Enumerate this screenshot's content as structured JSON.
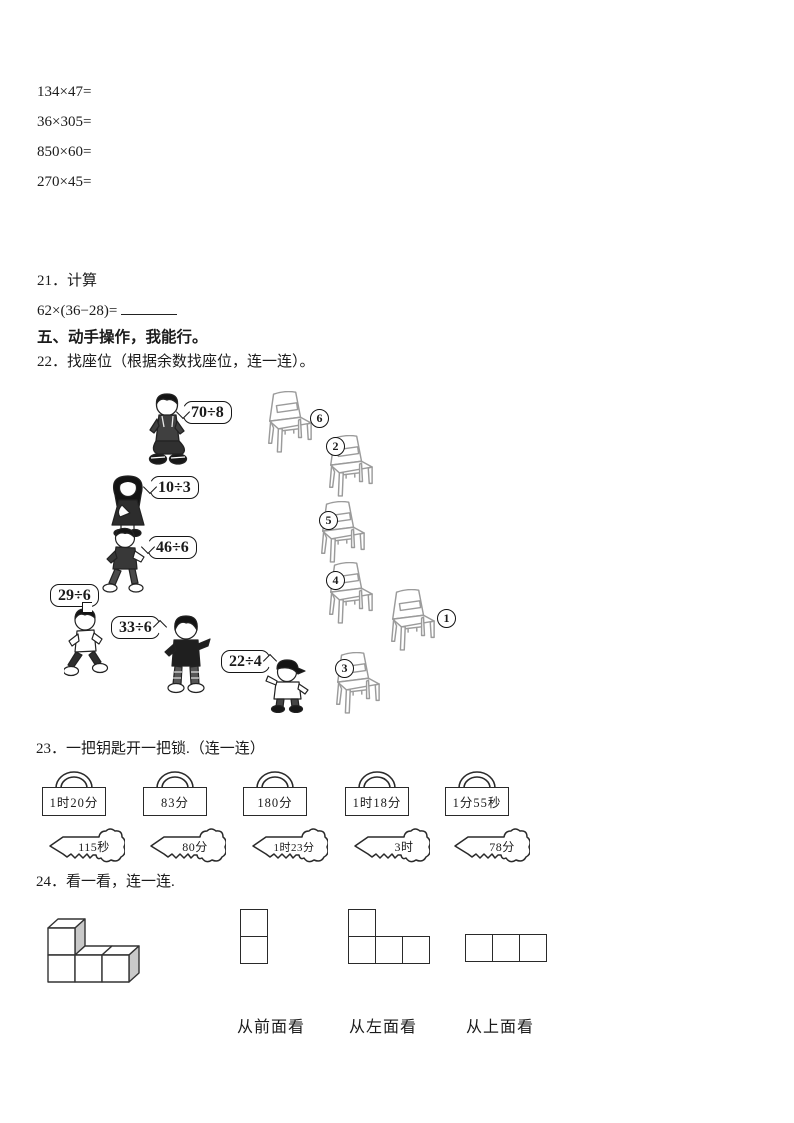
{
  "doc": {
    "calc_problems": [
      "134×47=",
      "36×305=",
      "850×60=",
      "270×45="
    ],
    "q21": {
      "label": "21．计算",
      "expression": "62×(36−28)="
    },
    "section5_title": "五、动手操作，我能行。",
    "q22": {
      "title": "22．找座位（根据余数找座位，连一连）。",
      "bubbles": [
        "70÷8",
        "10÷3",
        "46÷6",
        "29÷6",
        "33÷6",
        "22÷4"
      ],
      "chair_numbers": [
        "6",
        "2",
        "5",
        "4",
        "1",
        "3"
      ]
    },
    "q23": {
      "title": "23．一把钥匙开一把锁.（连一连）",
      "locks": [
        "1时20分",
        "83分",
        "180分",
        "1时18分",
        "1分55秒"
      ],
      "keys": [
        "115秒",
        "80分",
        "1时23分",
        "3时",
        "78分"
      ]
    },
    "q24": {
      "title": "24．看一看，连一连.",
      "view_labels": [
        "从前面看",
        "从左面看",
        "从上面看"
      ]
    },
    "colors": {
      "ink": "#1b1b1b",
      "sketch": "#999999",
      "paper": "#ffffff"
    }
  }
}
